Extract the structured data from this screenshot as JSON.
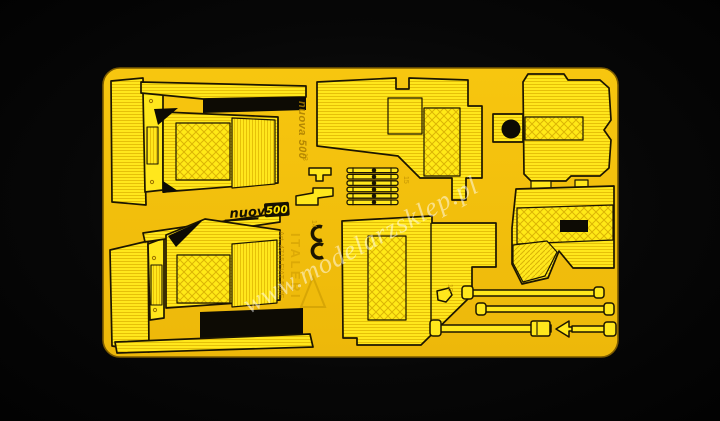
{
  "image": {
    "type": "product photo of a yellow photo-etched model detail fret on black background",
    "background_color": "#070707",
    "sheet": {
      "base_color": "#f3bf0c",
      "part_color": "#ffe71c",
      "etch_gap_color": "#0d0b04"
    }
  },
  "watermark": {
    "text": "www.modelarzsklep.pl"
  },
  "logo": {
    "script": "nuova",
    "box": "500"
  },
  "etched_markings": {
    "brand_vertical": "nuova 500",
    "kit_brand": "ITALERI",
    "kit_reference": "Art. 4715 FIAT 500F",
    "part_numbers": [
      "13",
      "14",
      "15",
      "10"
    ]
  }
}
